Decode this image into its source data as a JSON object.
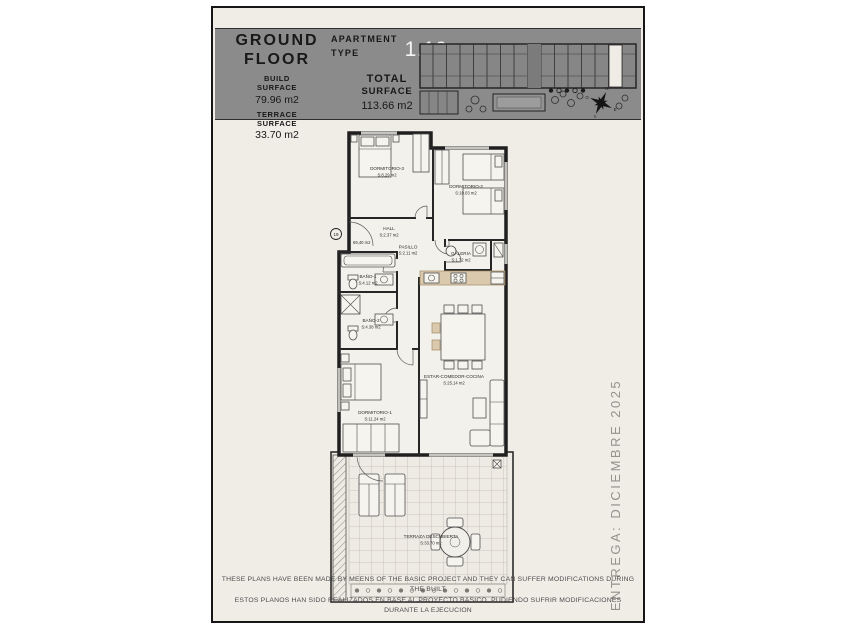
{
  "header": {
    "floor_line1": "GROUND",
    "floor_line2": "FLOOR",
    "build_label_1": "BUILD",
    "build_label_2": "SURFACE",
    "build_value": "79.96 m2",
    "terrace_label_1": "TERRACE",
    "terrace_label_2": "SURFACE",
    "terrace_value": "33.70 m2",
    "apt_label_1": "APARTMENT",
    "apt_label_2": "TYPE",
    "apt_value": "1.19",
    "total_label_1": "TOTAL",
    "total_label_2": "SURFACE",
    "total_value": "113.66 m2"
  },
  "plan": {
    "unit_number": "19",
    "useful_surface": "69,40 m2",
    "rooms": [
      {
        "name": "DORMITORIO-3",
        "area": "S:8.29 m2"
      },
      {
        "name": "DORMITORIO-2",
        "area": "S:10.03 m2"
      },
      {
        "name": "HALL",
        "area": "S:2.37 m2"
      },
      {
        "name": "PASILLO",
        "area": "S:2.11 m2"
      },
      {
        "name": "BAÑO-1",
        "area": "S:4.12 m2"
      },
      {
        "name": "BAÑO-2",
        "area": "S:4.38 m2"
      },
      {
        "name": "GALERIA",
        "area": "S:1.72 m2"
      },
      {
        "name": "DORMITORIO-1",
        "area": "S:11.24 m2"
      },
      {
        "name": "ESTAR-COMEDOR-COCINA",
        "area": "S:25.14 m2"
      },
      {
        "name": "TERRAZA DESCUBIERTA",
        "area": "S:33.70 m2"
      }
    ]
  },
  "compass": {
    "n": "N",
    "e": "E",
    "s": "S",
    "o": "O"
  },
  "delivery_note": "ENTREGA: DICIEMBRE 2025",
  "disclaimer": {
    "en": "THESE PLANS HAVE BEEN MADE BY MEENS OF THE BASIC PROJECT AND THEY CAN SUFFER MODIFICATIONS DURING THE BUILT",
    "es": "ESTOS PLANOS HAN SIDO REALIZADOS EN BASE AL PROYECTO BASICO, PUDIENDO SUFRIR MODIFICACIONES DURANTE LA EJECUCION"
  }
}
